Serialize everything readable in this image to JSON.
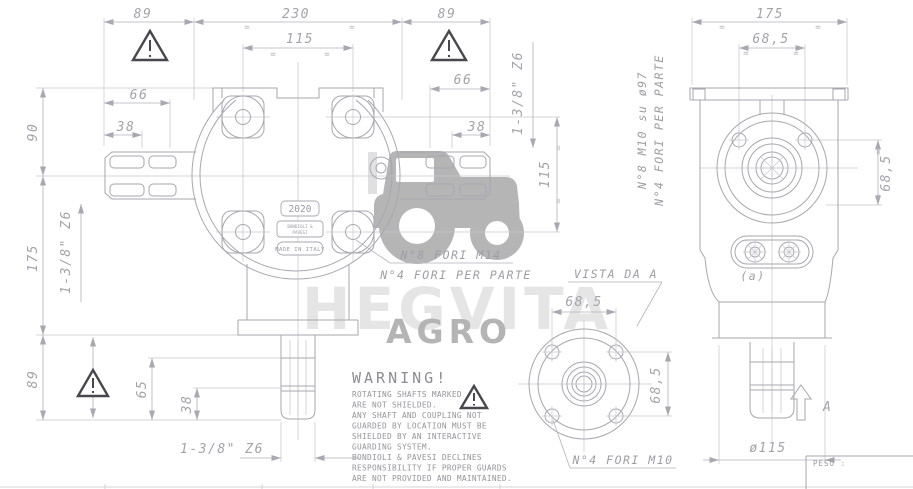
{
  "front": {
    "dims": {
      "w89l": "89",
      "w230": "230",
      "w89r": "89",
      "w115": "115",
      "l66": "66",
      "l38": "38",
      "r66": "66",
      "r38": "38",
      "h90": "90",
      "h175": "175",
      "h89": "89",
      "h65": "65",
      "h38": "38",
      "v115": "115"
    },
    "splines": {
      "left": "1-3/8\" Z6",
      "right": "1-3/8\" Z6",
      "bottom": "1-3/8\" Z6"
    },
    "notes": {
      "holes1": "N°8 FORI M14",
      "holes2": "N°4 FORI PER PARTE"
    },
    "plate": {
      "model": "2020",
      "brand1": "BONDIOLI &",
      "brand2": "PAVESI",
      "made": "MADE IN ITALY"
    }
  },
  "side": {
    "dims": {
      "w175": "175",
      "t685": "68,5",
      "r685": "68,5",
      "d115": "ø115"
    },
    "notes": {
      "holes1": "N°8 M10 su ø97",
      "holes2": "N°4 FORI PER PARTE",
      "a": "(a)",
      "arrow": "A"
    }
  },
  "vista": {
    "title": "VISTA DA A",
    "t685": "68,5",
    "r685": "68,5",
    "note": "N°4 FORI M10"
  },
  "warning": {
    "title": "WARNING!",
    "lines": [
      "ROTATING SHAFTS MARKED",
      "ARE NOT SHIELDED.",
      "ANY SHAFT AND COUPLING NOT",
      "GUARDED BY LOCATION MUST BE",
      "SHIELDED BY AN INTERACTIVE",
      "GUARDING SYSTEM.",
      "BONDIOLI & PAVESI DECLINES",
      "RESPONSIBILITY IF PROPER GUARDS",
      "ARE NOT PROVIDED AND MAINTAINED."
    ]
  },
  "titleblock": {
    "peso": "PESO :"
  },
  "watermark": {
    "brand": "HEGVITA",
    "sub": "AGRO"
  },
  "misc": {
    "eq": "="
  },
  "colors": {
    "line": "#a7a7af",
    "dark": "#47474d",
    "watermark_light": "#e5e5e5",
    "watermark_mid": "#b4b4b4"
  }
}
